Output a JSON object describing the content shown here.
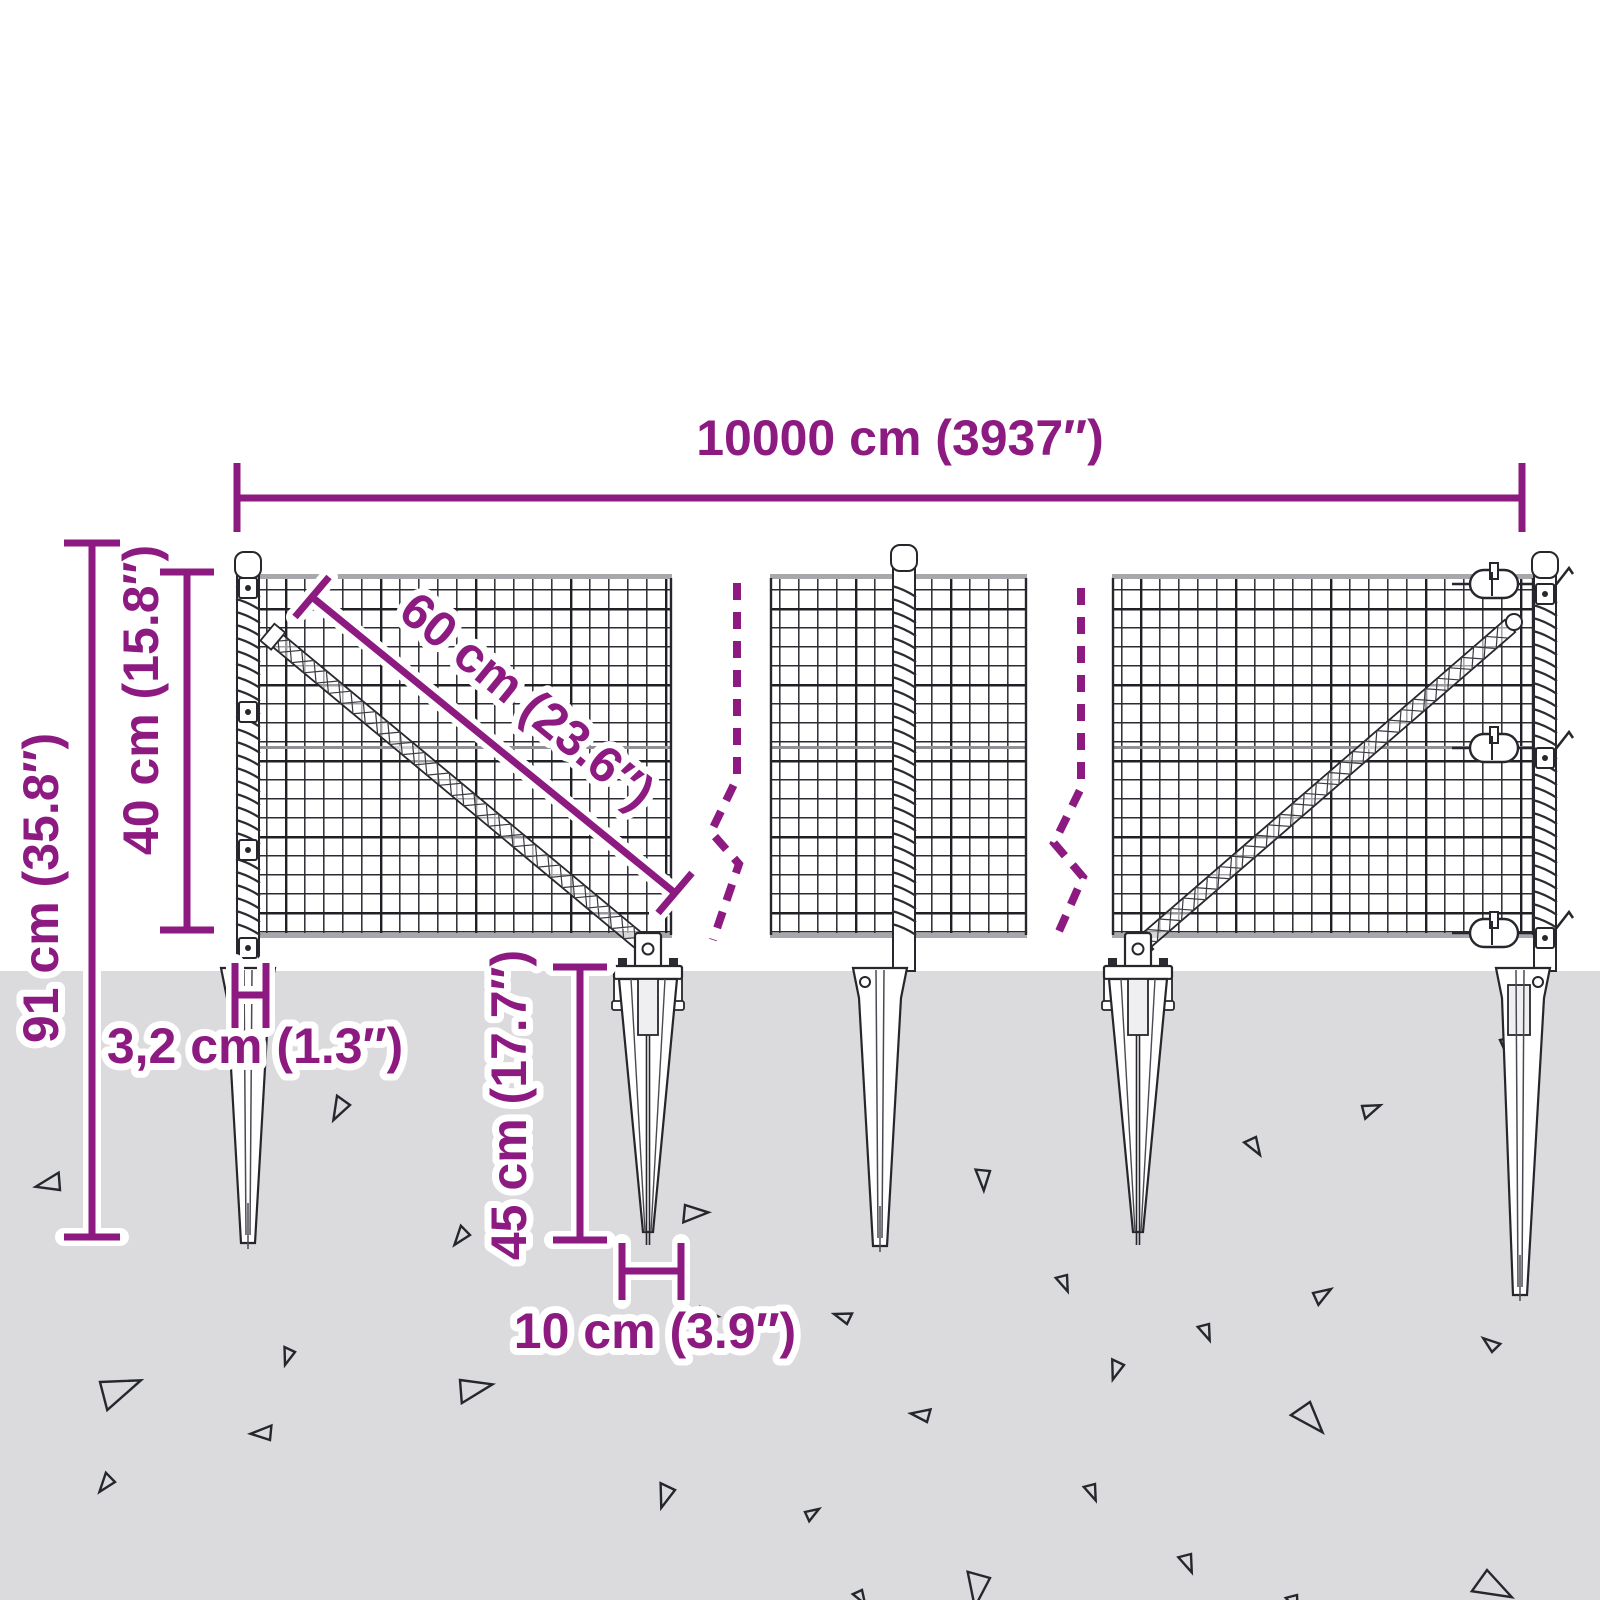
{
  "title": "Wire mesh fence with ground spikes — dimensions diagram",
  "colors": {
    "accent": "#8C1A80",
    "halo": "#FFFFFF",
    "ground": "#DBDBDD",
    "line_dark": "#26262C",
    "line_mid": "#4A4A52",
    "rail_gray": "#A7A7AC",
    "seam_gray": "#8F8F94",
    "metal_white": "#FFFFFF",
    "triangle_stroke": "#25272E"
  },
  "dimensions": {
    "total_width": {
      "label": "10000 cm (3937″)"
    },
    "total_height": {
      "label": "91 cm (35.8″)"
    },
    "mesh_height": {
      "label": "40 cm (15.8″)"
    },
    "diagonal": {
      "label": "60 cm (23.6″)"
    },
    "post_width": {
      "label": "3,2 cm (1.3″)"
    },
    "spike_depth": {
      "label": "45 cm (17.7″)"
    },
    "spike_width": {
      "label": "10 cm (3.9″)"
    }
  },
  "figure": {
    "ground_y": 971,
    "mesh_top": 578,
    "mesh_bottom": 935,
    "seam_y": 748,
    "cell": 19,
    "panels": [
      [
        240,
        672
      ],
      [
        770,
        1027
      ],
      [
        1112,
        1534
      ]
    ],
    "posts": [
      {
        "x": 248,
        "cap_y": 552,
        "clips": [
          578,
          702,
          840,
          938
        ],
        "spiral": [
          586,
          928
        ],
        "flags": false
      },
      {
        "x": 904,
        "cap_y": 545,
        "clips": [],
        "spiral": [
          586,
          928
        ],
        "flags": false
      },
      {
        "x": 1545,
        "cap_y": 552,
        "clips": [
          584,
          748,
          928
        ],
        "spiral": [
          592,
          922
        ],
        "flags": true
      }
    ],
    "braces": [
      {
        "x1": 272,
        "y1": 636,
        "x2": 645,
        "y2": 946
      },
      {
        "x1": 1140,
        "y1": 946,
        "x2": 1510,
        "y2": 626
      }
    ],
    "breaks": [
      "M737 583 V778 L711 832 L739 864 L713 940",
      "M1081 588 V788 L1054 843 L1083 877 L1056 938"
    ],
    "turnbuckles": {
      "cx": 1494,
      "ys": [
        584,
        748,
        933
      ]
    },
    "spikes": [
      {
        "x": 248,
        "type": "sleeve",
        "tip": 1243,
        "hole": -1
      },
      {
        "x": 648,
        "type": "plate",
        "tip": 1232,
        "bracket": true
      },
      {
        "x": 880,
        "type": "sleeve",
        "tip": 1246,
        "hole": -1
      },
      {
        "x": 1138,
        "type": "plate",
        "tip": 1232,
        "bracket": true
      },
      {
        "x": 1520,
        "type": "sleeveR",
        "tip": 1295,
        "hole": 1
      }
    ],
    "triangles": [
      [
        60,
        1190,
        24,
        200
      ],
      [
        350,
        1105,
        22,
        150
      ],
      [
        470,
        1235,
        18,
        160
      ],
      [
        685,
        1205,
        24,
        30
      ],
      [
        700,
        1307,
        20,
        40
      ],
      [
        295,
        1352,
        16,
        140
      ],
      [
        100,
        1382,
        40,
        10
      ],
      [
        460,
        1380,
        32,
        20
      ],
      [
        270,
        1440,
        20,
        210
      ],
      [
        115,
        1482,
        18,
        160
      ],
      [
        675,
        1490,
        22,
        140
      ],
      [
        865,
        1015,
        18,
        0
      ],
      [
        1500,
        1040,
        20,
        0
      ],
      [
        1362,
        1106,
        18,
        10
      ],
      [
        1256,
        1137,
        18,
        90
      ],
      [
        990,
        1171,
        20,
        120
      ],
      [
        1067,
        1275,
        16,
        100
      ],
      [
        1313,
        1293,
        18,
        0
      ],
      [
        847,
        1324,
        16,
        230
      ],
      [
        1209,
        1324,
        16,
        100
      ],
      [
        1124,
        1365,
        18,
        140
      ],
      [
        1492,
        1352,
        16,
        250
      ],
      [
        927,
        1422,
        18,
        220
      ],
      [
        1310,
        1402,
        32,
        80
      ],
      [
        1095,
        1484,
        16,
        100
      ],
      [
        805,
        1512,
        14,
        0
      ],
      [
        1191,
        1554,
        18,
        100
      ],
      [
        990,
        1578,
        32,
        130
      ],
      [
        862,
        1590,
        14,
        90
      ],
      [
        1487,
        1570,
        36,
        60
      ],
      [
        1297,
        1595,
        16,
        100
      ]
    ]
  }
}
